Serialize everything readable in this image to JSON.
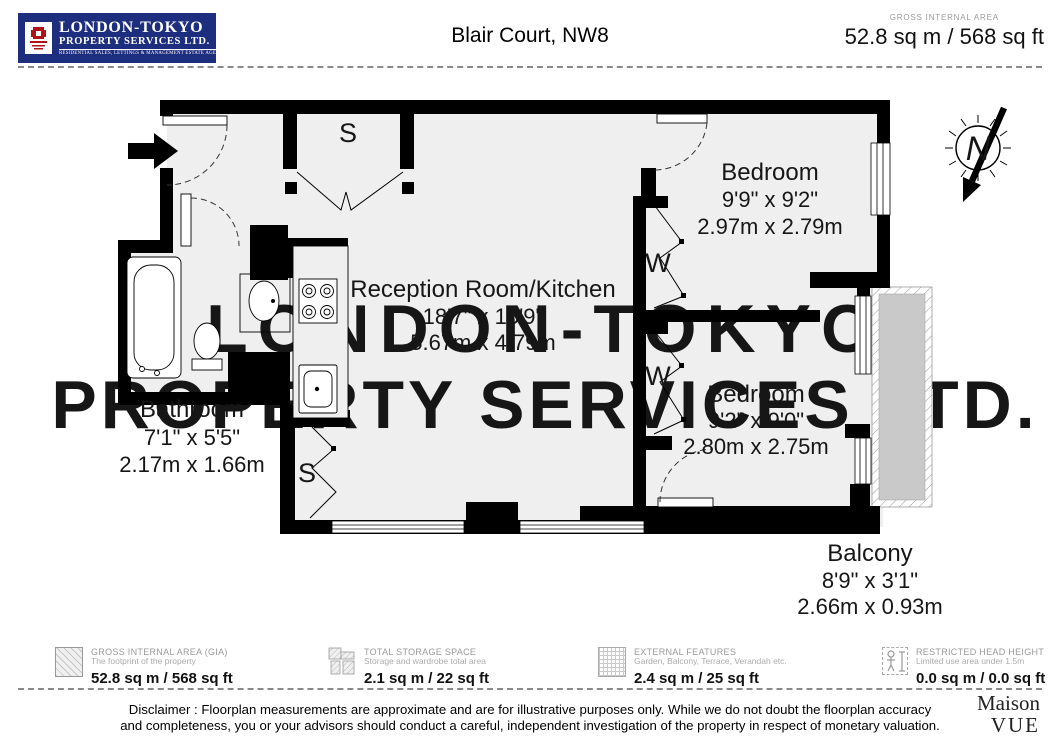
{
  "header": {
    "logo": {
      "name": "LONDON-TOKYO",
      "subname": "PROPERTY SERVICES LTD.",
      "tagline": "RESIDENTIAL SALES, LETTINGS & MANAGEMENT ESTATE AGENTS EST 1987",
      "bg_color": "#1e2e7e",
      "crest_color": "#b01218"
    },
    "title": "Blair Court, NW8",
    "gia_label": "GROSS INTERNAL AREA",
    "gia_value": "52.8 sq m / 568 sq ft"
  },
  "floorplan": {
    "watermark_line1": "LONDON-TOKYO",
    "watermark_line2": "PROPERTY SERVICES LTD.",
    "rooms": [
      {
        "name": "Reception Room/Kitchen",
        "imperial": "18'7\" x 15'9\"",
        "metric": "5.67m x 4.79m"
      },
      {
        "name": "Bedroom",
        "imperial": "9'9\" x 9'2\"",
        "metric": "2.97m x 2.79m"
      },
      {
        "name": "Bedroom",
        "imperial": "9'2\" x 9'0\"",
        "metric": "2.80m x 2.75m"
      },
      {
        "name": "Bathroom",
        "imperial": "7'1\" x 5'5\"",
        "metric": "2.17m x 1.66m"
      },
      {
        "name": "Balcony",
        "imperial": "8'9\" x 3'1\"",
        "metric": "2.66m x 0.93m"
      }
    ],
    "labels": {
      "storage": "S",
      "wardrobe": "W",
      "north": "N"
    },
    "balcony_fill": "#c9c9c9",
    "floor_fill": "#efefef"
  },
  "legend": {
    "items": [
      {
        "title": "GROSS INTERNAL AREA (GIA)",
        "subtitle": "The footprint of the property",
        "value": "52.8 sq m / 568 sq ft"
      },
      {
        "title": "TOTAL STORAGE SPACE",
        "subtitle": "Storage and wardrobe total area",
        "value": "2.1 sq m / 22 sq ft"
      },
      {
        "title": "EXTERNAL FEATURES",
        "subtitle": "Garden, Balcony, Terrace, Verandah etc.",
        "value": "2.4 sq m / 25 sq ft"
      },
      {
        "title": "RESTRICTED HEAD HEIGHT",
        "subtitle": "Limited use area under 1.5m",
        "value": "0.0 sq m / 0.0 sq ft"
      }
    ]
  },
  "footer": {
    "disclaimer_line1": "Disclaimer : Floorplan measurements are approximate and are for illustrative purposes only. While we do not doubt the floorplan accuracy",
    "disclaimer_line2": "and completeness, you or your advisors should conduct a careful, independent investigation of the property in respect of monetary valuation.",
    "brand_line1": "Maison",
    "brand_line2": "VUE"
  }
}
